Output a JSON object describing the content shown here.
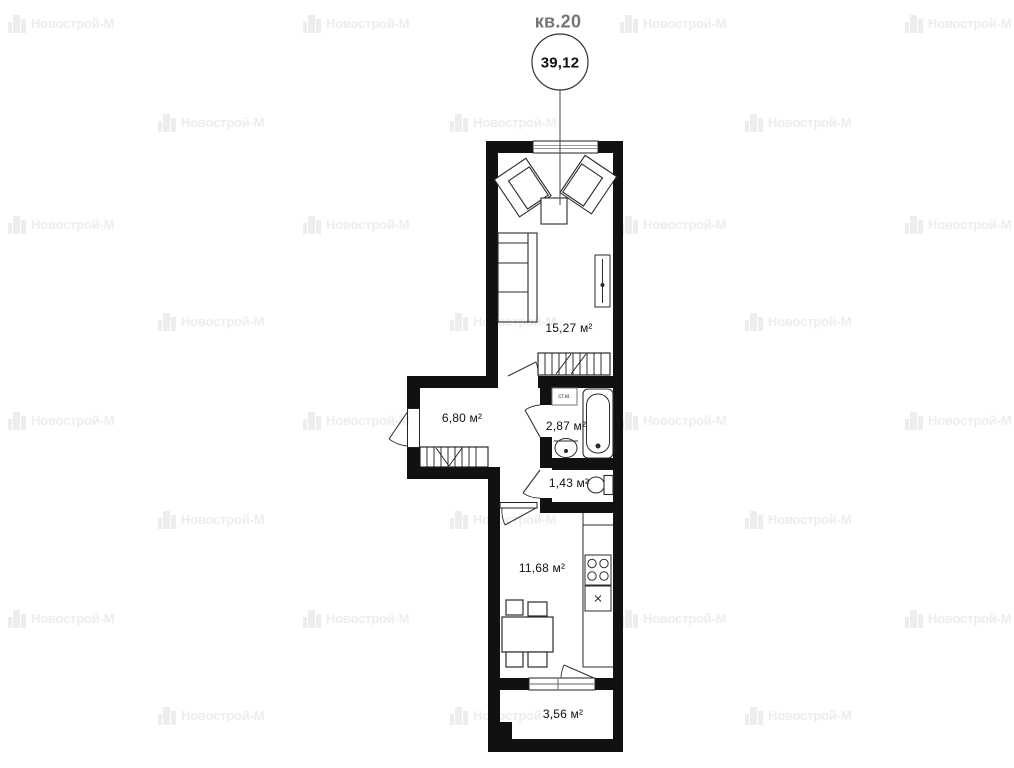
{
  "header": {
    "apartment_label": "кв.20",
    "total_area": "39,12"
  },
  "watermark": {
    "text": "Новострой-М",
    "color": "#ededed"
  },
  "rooms": [
    {
      "id": "living-room",
      "area": "15,27 м²"
    },
    {
      "id": "hallway",
      "area": "6,80 м²"
    },
    {
      "id": "bathroom",
      "area": "2,87 м²"
    },
    {
      "id": "wc",
      "area": "1,43 м²"
    },
    {
      "id": "kitchen",
      "area": "11,68 м²"
    },
    {
      "id": "balcony",
      "area": "3,56 м²"
    }
  ],
  "labels": {
    "washing_machine_abbr": "ст.м."
  },
  "colors": {
    "walls": "#111111",
    "furniture_stroke": "#2b2b2b",
    "apartment_label_color": "#757575"
  }
}
